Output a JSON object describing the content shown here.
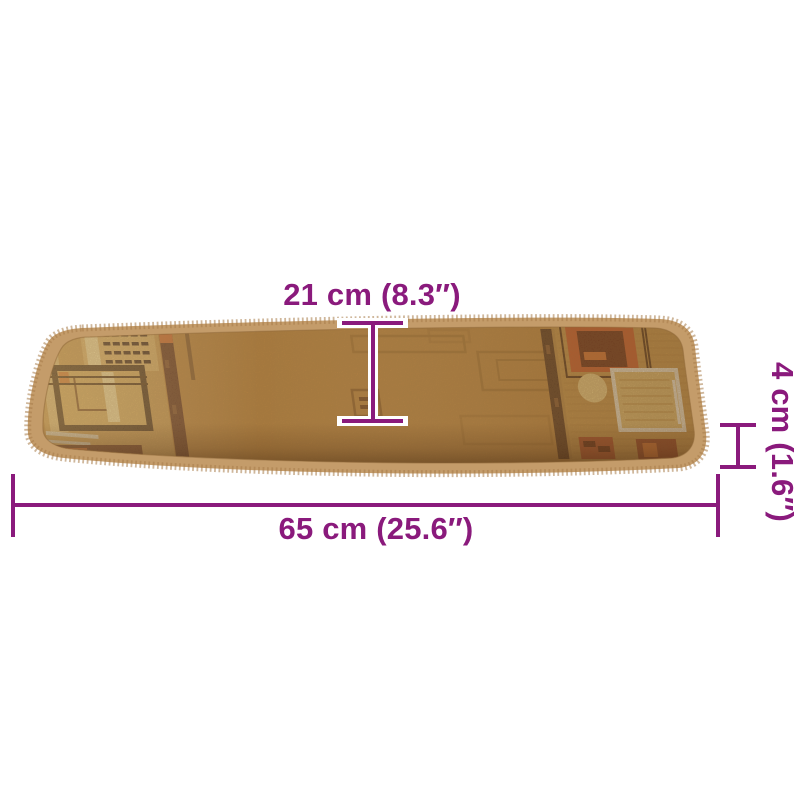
{
  "canvas": {
    "background": "#ffffff",
    "width": 800,
    "height": 800
  },
  "annotation": {
    "color": "#8a1a7c",
    "depth_label": "21 cm (8.3″)",
    "height_label": "4 cm (1.6″)",
    "width_label": "65 cm (25.6″)"
  },
  "product": {
    "item": "patterned carpet stair tread mat, perspective view",
    "colors": {
      "binding_edge": "#c49c6a",
      "carpet_field": "#b8823f",
      "left_panel_tan": "#c99c57",
      "right_panel_sand": "#c1914b",
      "stripe_maroon": "#5e3220",
      "stripe_dark_brown": "#4c2e1d",
      "accent_rust_orange": "#c4542a",
      "accent_dark_red": "#5e2414",
      "accent_cream": "#ecd9a0",
      "pale_circle_yellow": "#e6cb88",
      "pale_detail_white": "#ddd6c4"
    }
  }
}
